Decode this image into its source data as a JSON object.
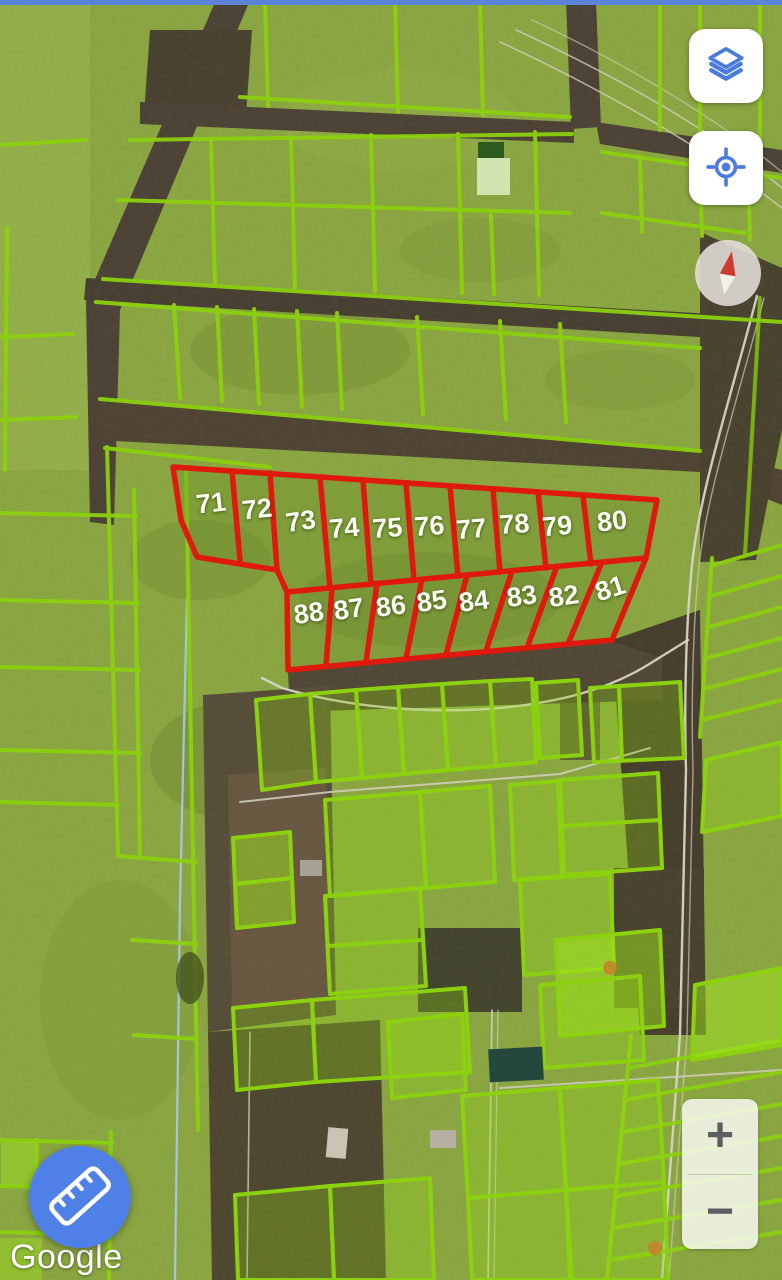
{
  "status_bar": {
    "color": "#5b84d8"
  },
  "map": {
    "attribution": "Google",
    "view_type": "satellite",
    "colors": {
      "parcel_outline_green": "#8cd10f",
      "highlight_red": "#e0190f",
      "parcel_label_white": "#fcfdf2",
      "road_brown": "#4a4034",
      "field_green": "#8aa83e",
      "utility_line_blue": "#a9c9f0"
    },
    "highlighted_block": {
      "top_row_numbers": [
        "71",
        "72",
        "73",
        "74",
        "75",
        "76",
        "77",
        "78",
        "79",
        "80"
      ],
      "bottom_row_numbers": [
        "88",
        "87",
        "86",
        "85",
        "84",
        "83",
        "82",
        "81"
      ]
    }
  },
  "controls": {
    "layers_button": {
      "icon": "layers-icon"
    },
    "my_location_button": {
      "icon": "my-location-icon"
    },
    "compass": {
      "icon": "compass-needle-icon"
    },
    "zoom": {
      "zoom_in_label": "+",
      "zoom_out_label": "−"
    },
    "measure_button": {
      "icon": "ruler-icon"
    }
  }
}
